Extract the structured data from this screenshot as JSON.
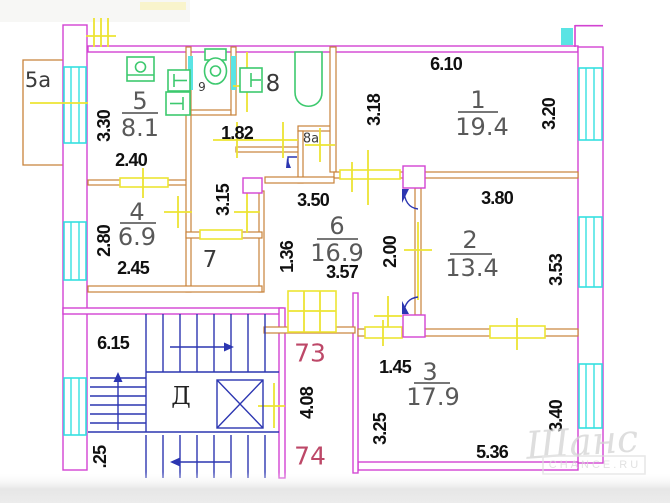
{
  "plan_labels": {
    "rooms": [
      {
        "number": "1",
        "area": "19.4"
      },
      {
        "number": "2",
        "area": "13.4"
      },
      {
        "number": "3",
        "area": "17.9"
      },
      {
        "number": "4",
        "area": "6.9"
      },
      {
        "number": "5",
        "area": "8.1"
      },
      {
        "number": "6",
        "area": "16.9"
      }
    ],
    "annexes": {
      "balcony": "5а",
      "wc": "9",
      "bathroom": "8",
      "closet": "8а",
      "pantry": "7",
      "elevator": "Д"
    },
    "apartments": {
      "upper": "73",
      "lower": "74"
    },
    "dims": {
      "d610": "6.10",
      "d318": "3.18",
      "d320": "3.20",
      "d330": "3.30",
      "d240": "2.40",
      "d182": "1.82",
      "d315": "3.15",
      "d280": "2.80",
      "d245": "2.45",
      "d350": "3.50",
      "d357": "3.57",
      "d136": "1.36",
      "d200": "2.00",
      "d380": "3.80",
      "d353": "3.53",
      "d615": "6.15",
      "d408": "4.08",
      "d025": ".25",
      "d145": "1.45",
      "d325": "3.25",
      "d536": "5.36",
      "d340": "3.40"
    }
  },
  "watermark": {
    "script": "Шанс",
    "caption": "CHANCE.RU"
  },
  "colors": {
    "exterior_wall": "#d243d2",
    "interior_wall": "#c8823a",
    "window": "#35e0e0",
    "survey_marker": "#ede433",
    "fixture": "#3dc96e",
    "stairs": "#2c36b1",
    "apartment_number": "#bd4868",
    "dimension_text": "#101010",
    "room_text": "#595959"
  }
}
